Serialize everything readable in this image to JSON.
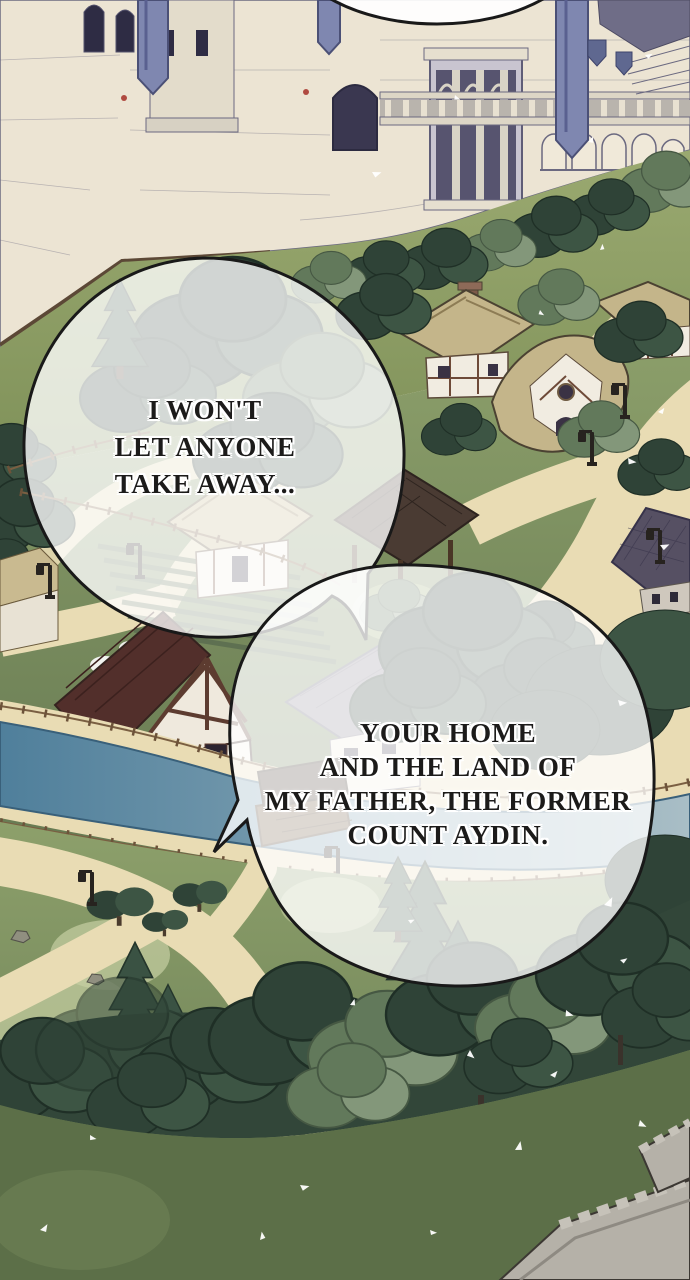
{
  "dialogue": {
    "bubble1": {
      "lines": [
        "I WON'T",
        "LET ANYONE",
        "TAKE AWAY..."
      ]
    },
    "bubble2": {
      "lines": [
        "YOUR HOME",
        "AND THE LAND OF",
        "MY FATHER, THE FORMER",
        "COUNT AYDIN."
      ]
    }
  },
  "palette": {
    "castle_wall": "#ece4d3",
    "banner_blue": "#7f87b0",
    "sand": "#e9dcb4",
    "thatch": "#c4b58a",
    "tree_dark": "#2f4337",
    "tree_mid": "#3d5544",
    "tree_light": "#62795b",
    "maroon_roof": "#522f2b",
    "river_blue": "#4f7f9b",
    "river_pale": "#a9bec6",
    "stone_grey": "#b5b1a8",
    "lawn_dark": "#5c6f48",
    "bubble_fill": "#ffffff",
    "bubble_outline": "#191919",
    "text_ink": "#1c1b1a"
  }
}
